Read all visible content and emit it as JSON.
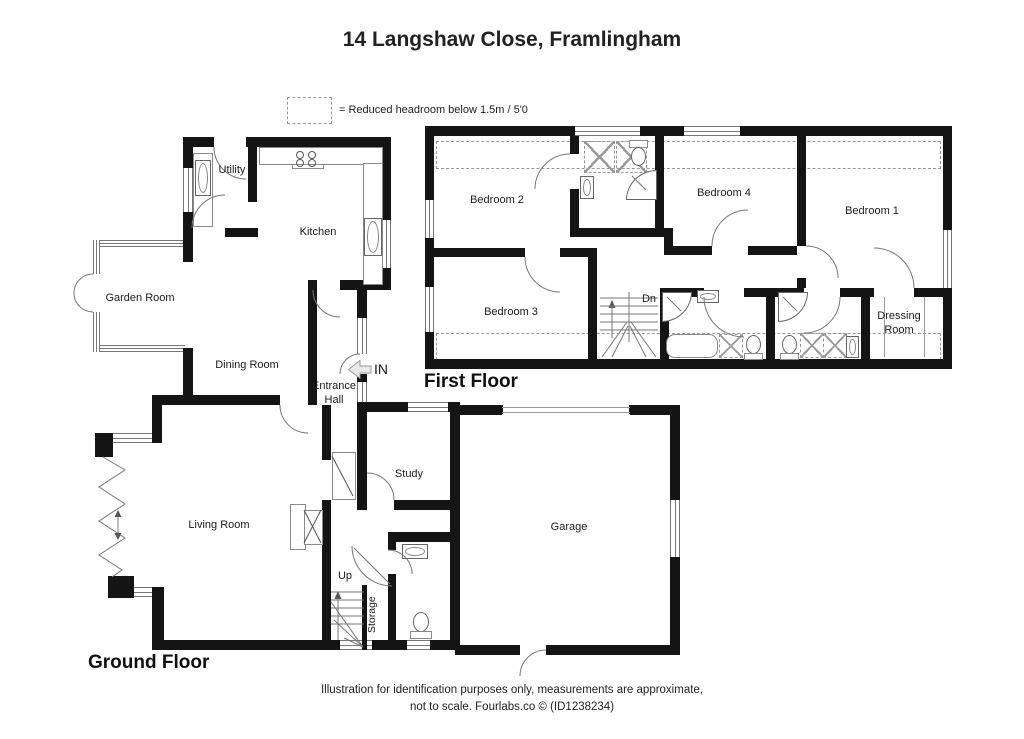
{
  "title": "14 Langshaw Close, Framlingham",
  "legend": {
    "text": "= Reduced headroom below 1.5m / 5'0"
  },
  "floors": {
    "first": {
      "label": "First Floor",
      "rooms": {
        "bedroom1": "Bedroom 1",
        "bedroom2": "Bedroom 2",
        "bedroom3": "Bedroom 3",
        "bedroom4": "Bedroom 4",
        "dressing_room": "Dressing Room",
        "stairs_down": "Dn"
      }
    },
    "ground": {
      "label": "Ground Floor",
      "rooms": {
        "utility": "Utility",
        "kitchen": "Kitchen",
        "garden_room": "Garden Room",
        "dining_room": "Dining Room",
        "entrance_hall": "Entrance Hall",
        "entrance_marker": "IN",
        "study": "Study",
        "living_room": "Living Room",
        "garage": "Garage",
        "stairs_up": "Up",
        "storage": "Storage"
      }
    }
  },
  "footer": {
    "line1": "Illustration for identification purposes only, measurements are approximate,",
    "line2": "not to scale. Fourlabs.co © (ID1238234)"
  },
  "colors": {
    "wall": "#141414",
    "line": "#777777",
    "dash": "#9a9a9a"
  }
}
